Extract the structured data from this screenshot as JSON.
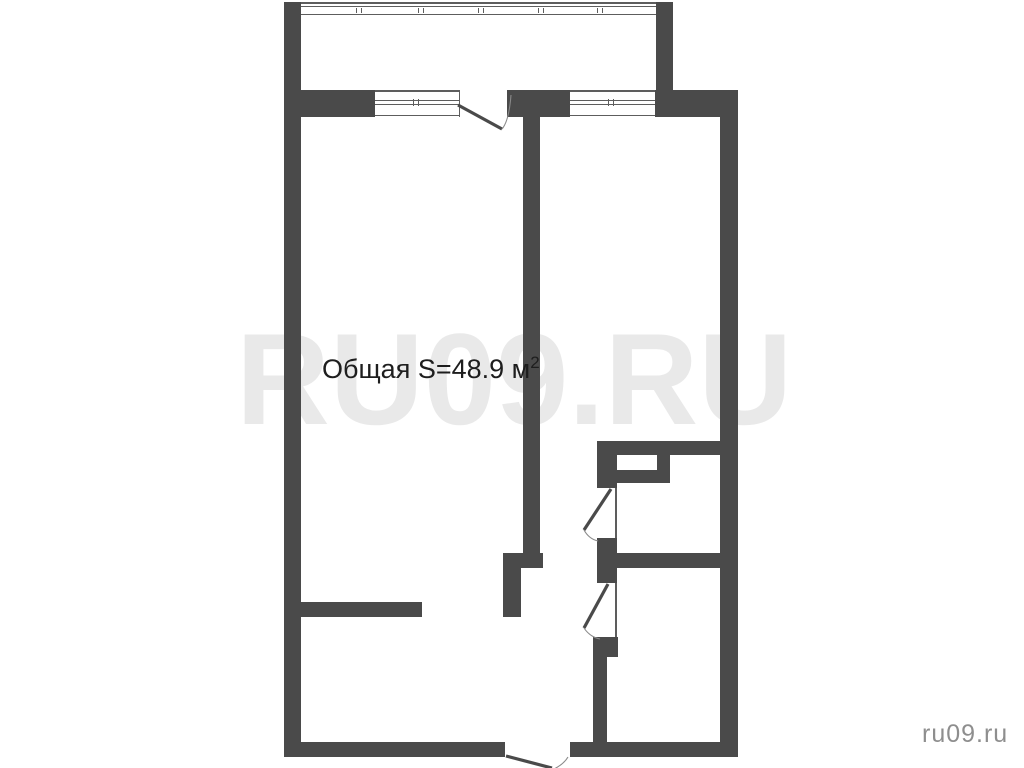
{
  "area_label": {
    "text": "Общая S=48.9 м",
    "sup": "2"
  },
  "watermark": {
    "text": "RU09.RU",
    "color": "#e9e9e9"
  },
  "corner_brand": {
    "text": "ru09.ru",
    "color": "#8e8e8e"
  },
  "floorplan": {
    "wall_color": "#4a4a4a",
    "thin_line_color": "#5d5d5d",
    "door_leaf_color": "#4a4a4a",
    "door_arc_color": "#8a8a8a",
    "walls": [
      {
        "name": "outer-wall-left",
        "x": 284,
        "y": 2,
        "w": 17,
        "h": 755
      },
      {
        "name": "balcony-wall-right",
        "x": 656,
        "y": 2,
        "w": 17,
        "h": 89
      },
      {
        "name": "front-wall-segment-a",
        "x": 301,
        "y": 90,
        "w": 74,
        "h": 27
      },
      {
        "name": "front-wall-segment-b",
        "x": 507,
        "y": 90,
        "w": 63,
        "h": 27
      },
      {
        "name": "front-wall-segment-c",
        "x": 655,
        "y": 90,
        "w": 83,
        "h": 27
      },
      {
        "name": "outer-wall-right",
        "x": 720,
        "y": 117,
        "w": 18,
        "h": 640
      },
      {
        "name": "bottom-wall-left",
        "x": 284,
        "y": 742,
        "w": 221,
        "h": 15
      },
      {
        "name": "bottom-wall-right",
        "x": 570,
        "y": 742,
        "w": 168,
        "h": 15
      },
      {
        "name": "room-divider-wall",
        "x": 523,
        "y": 117,
        "w": 17,
        "h": 438
      },
      {
        "name": "divider-jog-cap",
        "x": 503,
        "y": 553,
        "w": 40,
        "h": 15
      },
      {
        "name": "divider-jog-lower",
        "x": 503,
        "y": 568,
        "w": 18,
        "h": 49
      },
      {
        "name": "kitchen-stub-wall",
        "x": 301,
        "y": 602,
        "w": 121,
        "h": 15
      },
      {
        "name": "bathroom-top-wall",
        "x": 597,
        "y": 441,
        "w": 141,
        "h": 14
      },
      {
        "name": "hall-wall-segment-1",
        "x": 597,
        "y": 455,
        "w": 20,
        "h": 33
      },
      {
        "name": "hall-wall-segment-2",
        "x": 597,
        "y": 538,
        "w": 20,
        "h": 45
      },
      {
        "name": "hall-wall-segment-3-pier",
        "x": 593,
        "y": 637,
        "w": 25,
        "h": 20
      },
      {
        "name": "hall-wall-segment-3",
        "x": 593,
        "y": 657,
        "w": 14,
        "h": 85
      },
      {
        "name": "duct-box-bottom",
        "x": 597,
        "y": 470,
        "w": 73,
        "h": 13
      },
      {
        "name": "duct-box-right",
        "x": 657,
        "y": 455,
        "w": 13,
        "h": 28
      },
      {
        "name": "bathrooms-divider-wall",
        "x": 617,
        "y": 553,
        "w": 103,
        "h": 15
      }
    ],
    "thin_lines": [
      {
        "name": "balcony-glazing-line",
        "x": 301,
        "y": 2,
        "w": 355,
        "h": 1.8
      },
      {
        "name": "balcony-glazing-line",
        "x": 301,
        "y": 6,
        "w": 355,
        "h": 1.1
      },
      {
        "name": "balcony-glazing-line",
        "x": 301,
        "y": 13.5,
        "w": 355,
        "h": 1.8
      },
      {
        "name": "glazing-tick",
        "x": 356,
        "y": 7.5,
        "w": 1.3,
        "h": 5.5
      },
      {
        "name": "glazing-tick",
        "x": 361,
        "y": 7.5,
        "w": 1.3,
        "h": 5.5
      },
      {
        "name": "glazing-tick",
        "x": 418,
        "y": 7.5,
        "w": 1.3,
        "h": 5.5
      },
      {
        "name": "glazing-tick",
        "x": 423,
        "y": 7.5,
        "w": 1.3,
        "h": 5.5
      },
      {
        "name": "glazing-tick",
        "x": 478,
        "y": 7.5,
        "w": 1.3,
        "h": 5.5
      },
      {
        "name": "glazing-tick",
        "x": 483,
        "y": 7.5,
        "w": 1.3,
        "h": 5.5
      },
      {
        "name": "glazing-tick",
        "x": 538,
        "y": 7.5,
        "w": 1.3,
        "h": 5.5
      },
      {
        "name": "glazing-tick",
        "x": 543,
        "y": 7.5,
        "w": 1.3,
        "h": 5.5
      },
      {
        "name": "glazing-tick",
        "x": 597,
        "y": 7.5,
        "w": 1.3,
        "h": 5.5
      },
      {
        "name": "glazing-tick",
        "x": 602,
        "y": 7.5,
        "w": 1.3,
        "h": 5.5
      },
      {
        "name": "window-line",
        "x": 375,
        "y": 90,
        "w": 85,
        "h": 1.6
      },
      {
        "name": "window-line",
        "x": 375,
        "y": 114.8,
        "w": 85,
        "h": 1.6
      },
      {
        "name": "window-line",
        "x": 375,
        "y": 100,
        "w": 85,
        "h": 1.2
      },
      {
        "name": "window-line",
        "x": 375,
        "y": 103.6,
        "w": 85,
        "h": 1.2
      },
      {
        "name": "window-jamb",
        "x": 458.5,
        "y": 90,
        "w": 1.5,
        "h": 27
      },
      {
        "name": "window-tick",
        "x": 413,
        "y": 98.5,
        "w": 1.4,
        "h": 7
      },
      {
        "name": "window-tick",
        "x": 417.6,
        "y": 98.5,
        "w": 1.4,
        "h": 7
      },
      {
        "name": "window-line",
        "x": 570,
        "y": 90,
        "w": 85,
        "h": 1.6
      },
      {
        "name": "window-line",
        "x": 570,
        "y": 114.8,
        "w": 85,
        "h": 1.6
      },
      {
        "name": "window-line",
        "x": 570,
        "y": 100,
        "w": 85,
        "h": 1.2
      },
      {
        "name": "window-line",
        "x": 570,
        "y": 103.6,
        "w": 85,
        "h": 1.2
      },
      {
        "name": "window-tick",
        "x": 608,
        "y": 98.5,
        "w": 1.4,
        "h": 7
      },
      {
        "name": "window-tick",
        "x": 612.6,
        "y": 98.5,
        "w": 1.4,
        "h": 7
      },
      {
        "name": "door-jamb-line",
        "x": 615,
        "y": 488,
        "w": 1.6,
        "h": 50
      },
      {
        "name": "door-jamb-line",
        "x": 615,
        "y": 583,
        "w": 1.6,
        "h": 54
      }
    ],
    "door_leaves": [
      {
        "name": "balcony-door-leaf",
        "x1": 458,
        "y1": 105,
        "x2": 502,
        "y2": 129
      },
      {
        "name": "wc1-door-leaf",
        "x1": 611,
        "y1": 489,
        "x2": 584,
        "y2": 530
      },
      {
        "name": "wc2-door-leaf",
        "x1": 608,
        "y1": 584,
        "x2": 584,
        "y2": 628
      },
      {
        "name": "entrance-door-leaf",
        "x1": 506,
        "y1": 756,
        "x2": 552,
        "y2": 768
      }
    ],
    "door_arcs": [
      {
        "name": "balcony-door-arc",
        "d": "M502,129 Q509,121 511,95"
      },
      {
        "name": "wc1-door-arc",
        "d": "M584,530 Q589,539 598,541"
      },
      {
        "name": "wc2-door-arc",
        "d": "M584,628 Q590,637 600,639"
      },
      {
        "name": "entrance-door-arc",
        "d": "M568,757 Q564,764 554,769"
      }
    ]
  }
}
